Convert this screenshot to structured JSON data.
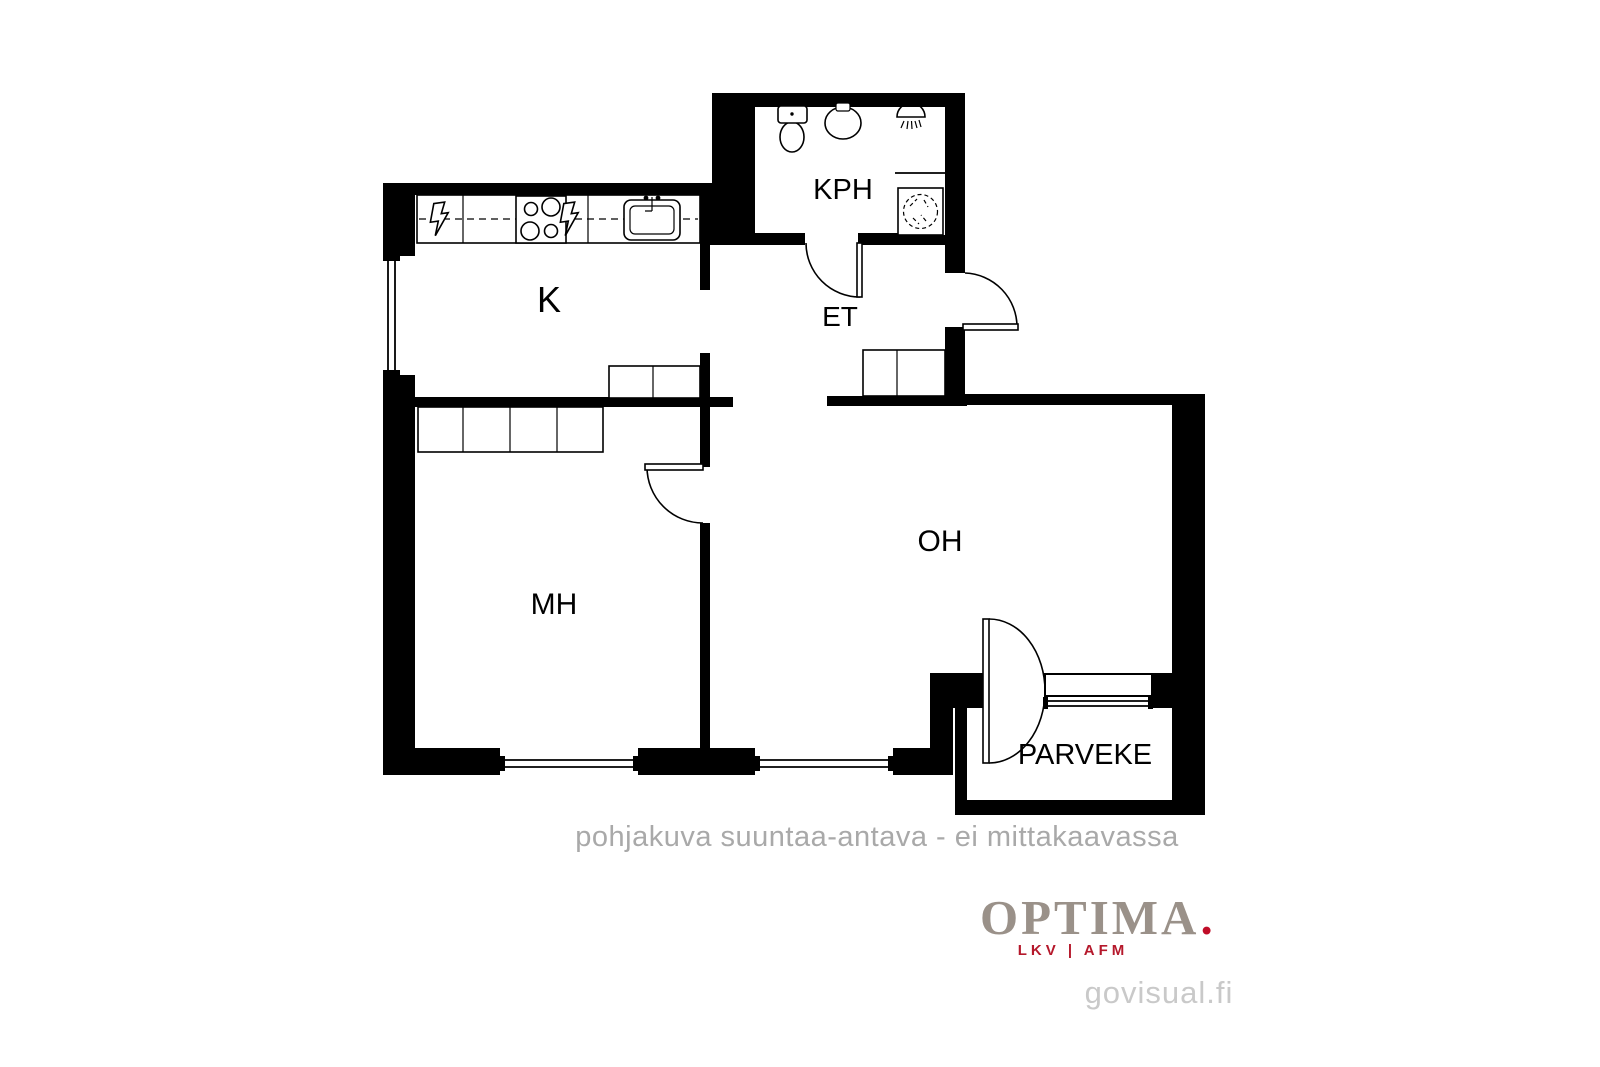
{
  "floorplan": {
    "rooms": [
      {
        "id": "kitchen",
        "label": "K"
      },
      {
        "id": "bathroom",
        "label": "KPH"
      },
      {
        "id": "entry",
        "label": "ET"
      },
      {
        "id": "bedroom",
        "label": "MH"
      },
      {
        "id": "living-room",
        "label": "OH"
      },
      {
        "id": "balcony",
        "label": "PARVEKE"
      }
    ],
    "icons": [
      "toilet-icon",
      "bathroom-sink-icon",
      "shower-icon",
      "washing-machine-icon",
      "stove-icon",
      "kitchen-sink-icon",
      "electrical-appliance-icon"
    ],
    "disclaimer": "pohjakuva suuntaa-antava - ei mittakaavassa"
  },
  "branding": {
    "logo_text": "OPTIMA",
    "logo_dot": ".",
    "logo_tagline": "LKV | AFM",
    "watermark": "govisual.fi"
  },
  "colors": {
    "wall": "#000000",
    "disclaimer_text": "#a9a9a9",
    "logo_text": "#9a9189",
    "logo_accent": "#c00d28",
    "watermark_text": "#c9c9c9"
  }
}
